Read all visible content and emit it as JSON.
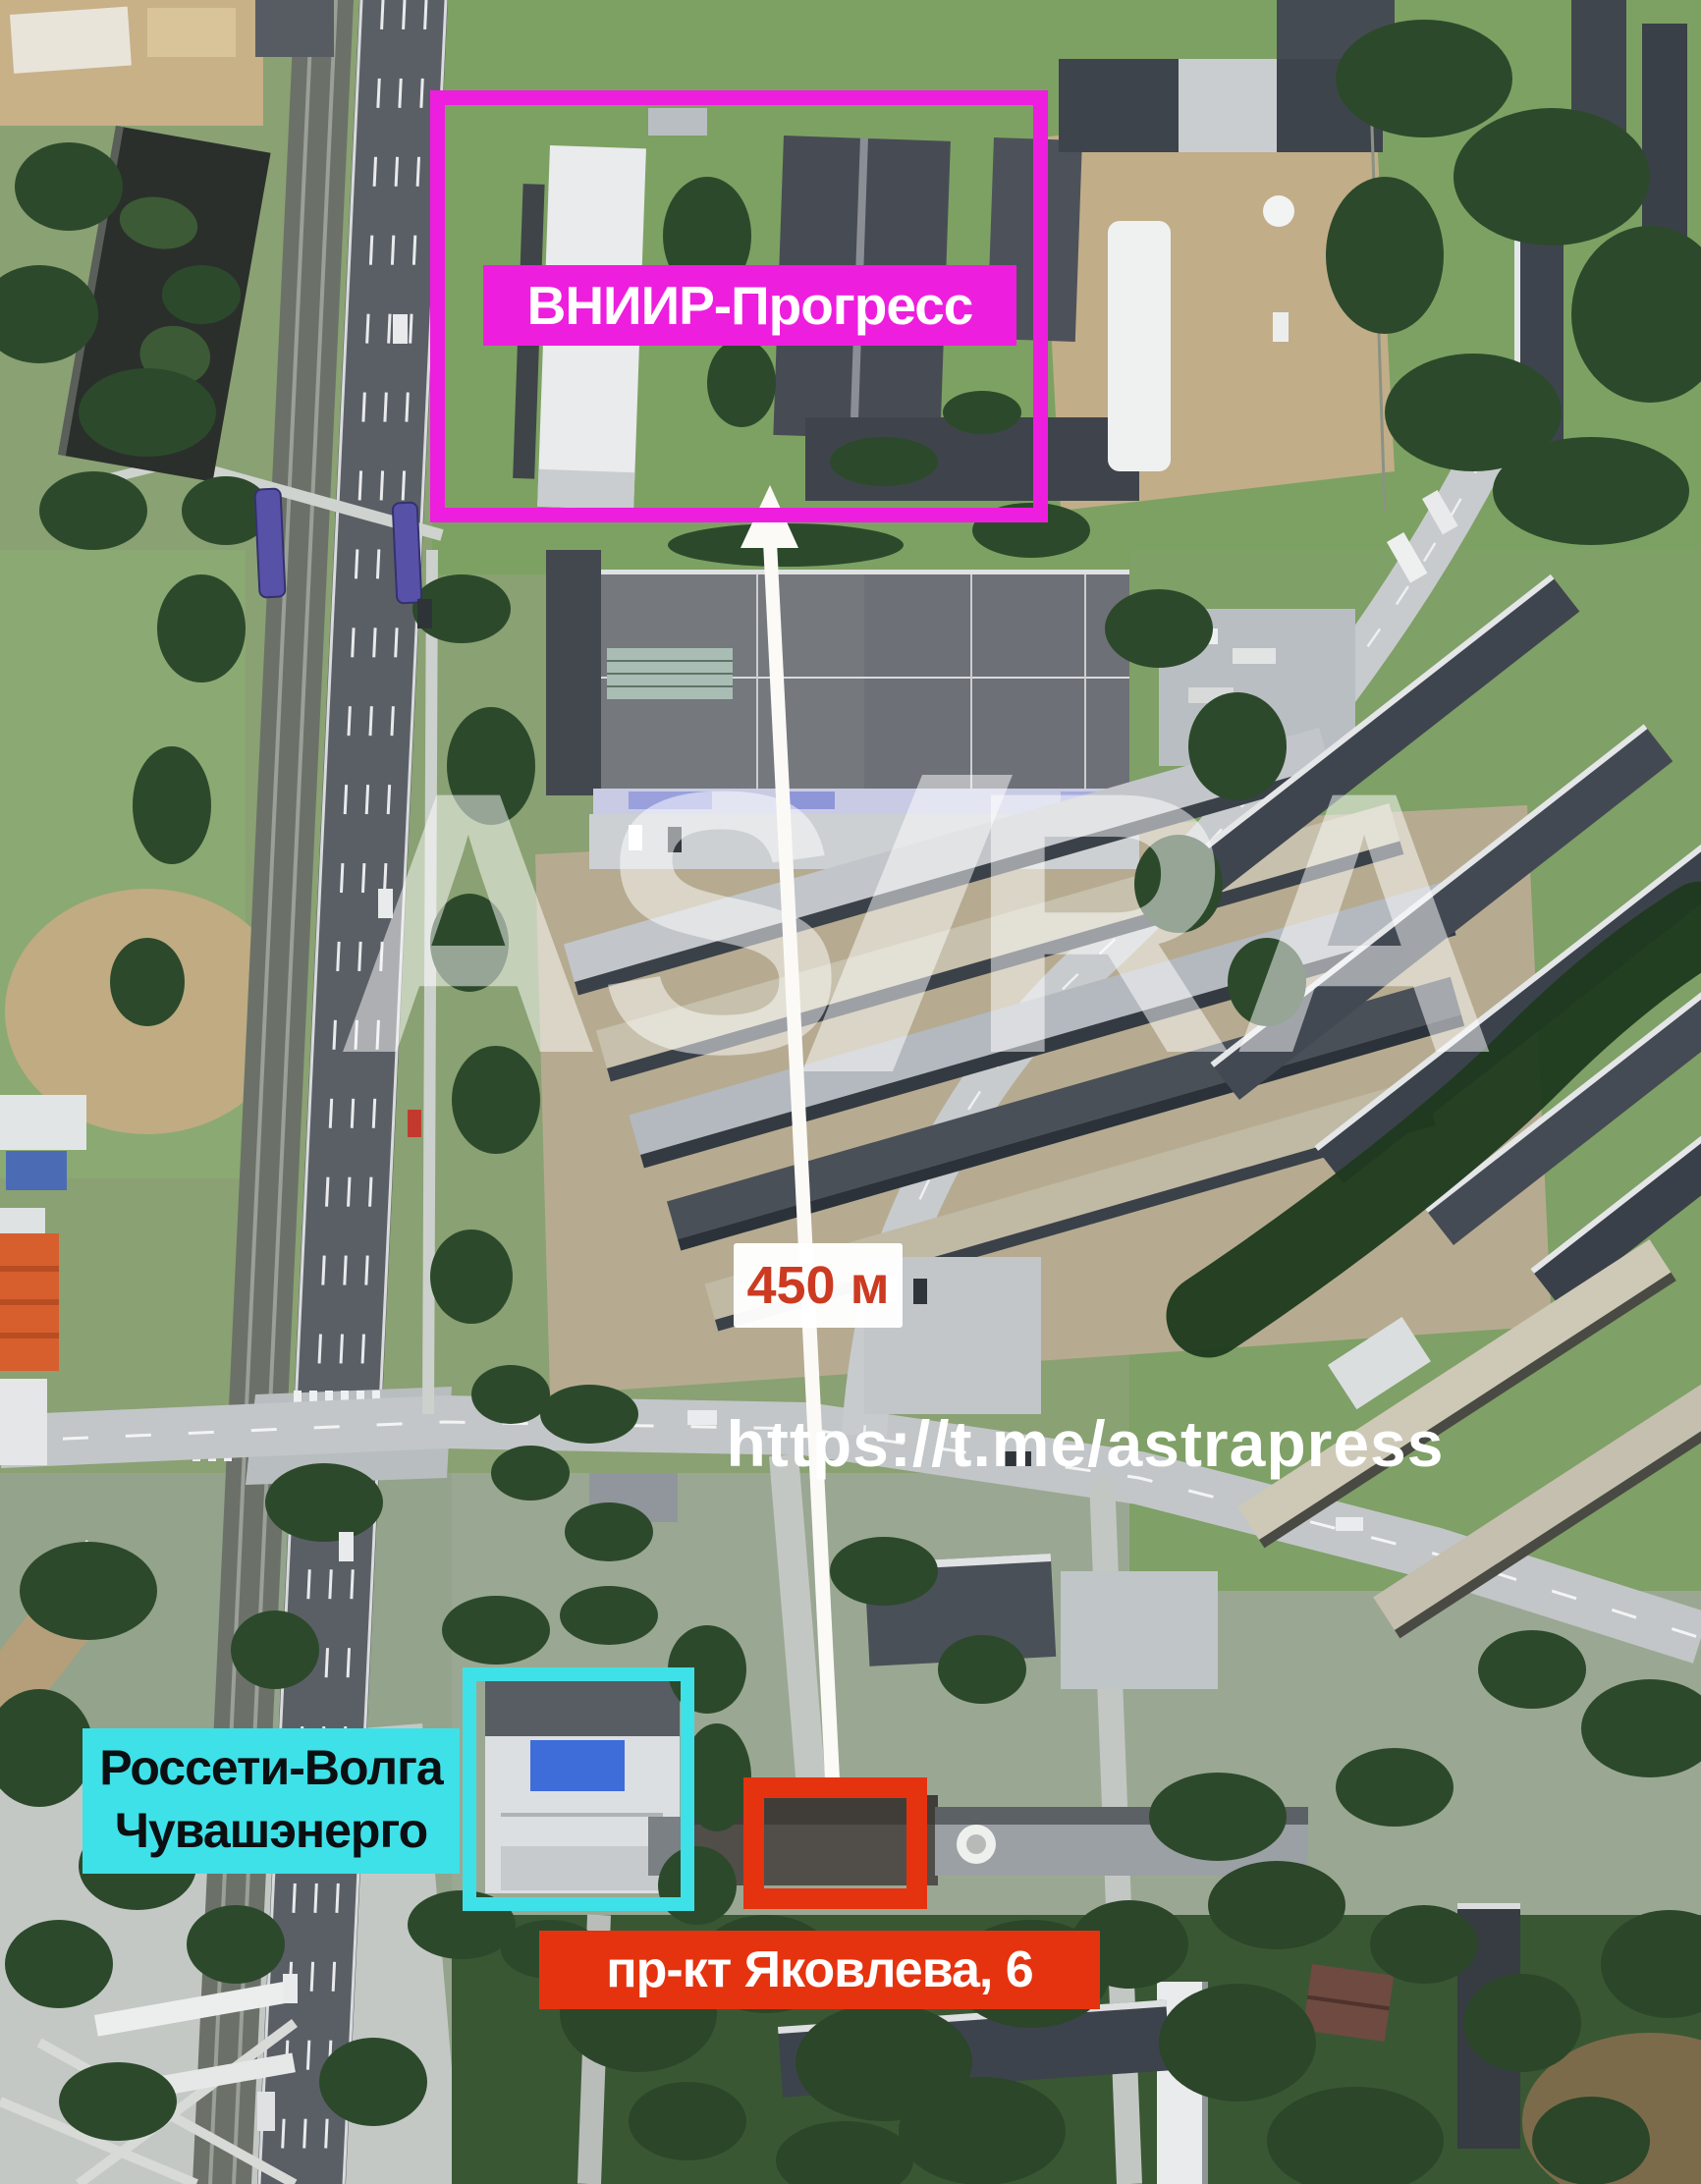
{
  "annotations": {
    "facility_box_label": "ВНИИР-Прогресс",
    "distance_label": "450 м",
    "telegram_link": "https://t.me/astrapress",
    "watermark_left": "AS",
    "watermark_right": "RA",
    "substation_label_line1": "Россети-Волга",
    "substation_label_line2": "Чувашэнерго",
    "address_label": "пр-кт Яковлева, 6"
  },
  "colors": {
    "magenta": "#ee1ede",
    "cyan": "#3ee1e8",
    "red": "#e5330f",
    "distanceText": "#cc3a21",
    "labelTextDark": "#0c0f11",
    "arrowWhite": "#fbfaf7"
  }
}
